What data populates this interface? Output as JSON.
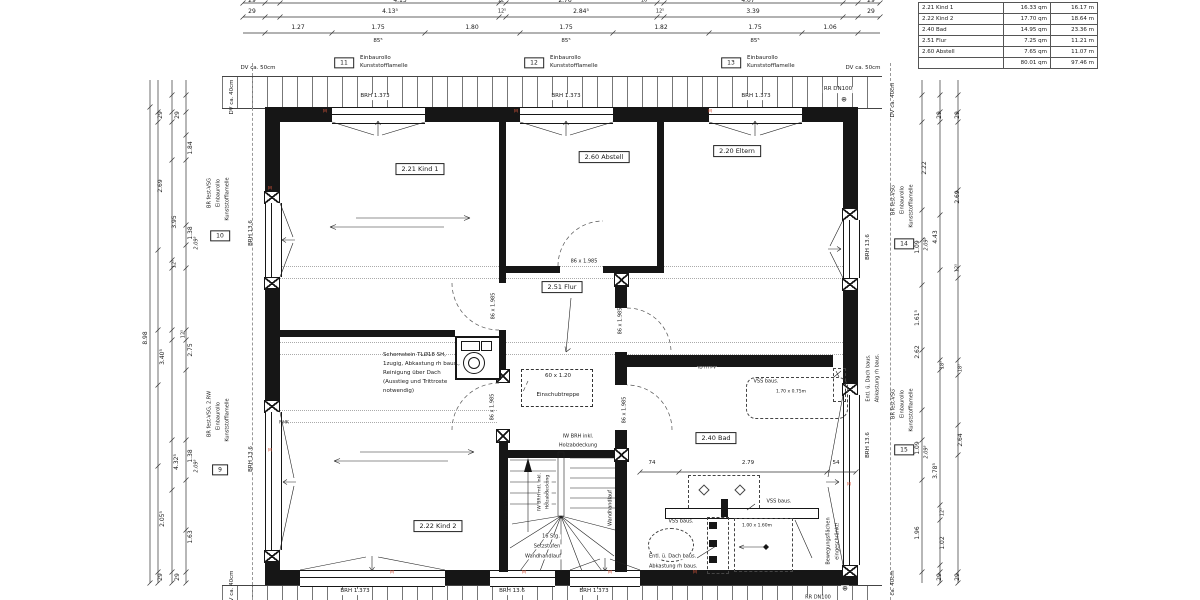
{
  "accent_red": "#d4543a",
  "area_table": {
    "rows": [
      {
        "name": "2.21 Kind 1",
        "area": "16.33 qm",
        "len": "16.17 m"
      },
      {
        "name": "2.22 Kind 2",
        "area": "17.70 qm",
        "len": "18.64 m"
      },
      {
        "name": "2.40 Bad",
        "area": "14.95 qm",
        "len": "23.36 m"
      },
      {
        "name": "2.51 Flur",
        "area": "7.25 qm",
        "len": "11.21 m"
      },
      {
        "name": "2.60 Abstell",
        "area": "7.65 qm",
        "len": "11.07 m"
      },
      {
        "name": "",
        "area": "80.01 qm",
        "len": "97.46 m"
      }
    ]
  },
  "labels": [
    {
      "n": "dim-label",
      "t": "29",
      "x": 252,
      "y": 1
    },
    {
      "n": "dim-label",
      "t": "4.15",
      "x": 400,
      "y": 1
    },
    {
      "n": "dim-label",
      "t": "12⁵",
      "x": 502,
      "y": 1,
      "s": 5
    },
    {
      "n": "dim-label",
      "t": "2.76",
      "x": 565,
      "y": 1
    },
    {
      "n": "dim-label",
      "t": "16⁵",
      "x": 645,
      "y": 1,
      "s": 5
    },
    {
      "n": "dim-label",
      "t": "4.07",
      "x": 748,
      "y": 1
    },
    {
      "n": "dim-label",
      "t": "29",
      "x": 871,
      "y": 1
    },
    {
      "n": "dim-label",
      "t": "29",
      "x": 252,
      "y": 12
    },
    {
      "n": "dim-label",
      "t": "4.13⁵",
      "x": 390,
      "y": 12
    },
    {
      "n": "dim-label",
      "t": "12⁵",
      "x": 502,
      "y": 12,
      "s": 5
    },
    {
      "n": "dim-label",
      "t": "2.84⁵",
      "x": 581,
      "y": 12
    },
    {
      "n": "dim-label",
      "t": "12⁵",
      "x": 660,
      "y": 12,
      "s": 5
    },
    {
      "n": "dim-label",
      "t": "3.39",
      "x": 753,
      "y": 12
    },
    {
      "n": "dim-label",
      "t": "29",
      "x": 871,
      "y": 12
    },
    {
      "n": "dim-label",
      "t": "1.27",
      "x": 298,
      "y": 28
    },
    {
      "n": "dim-label",
      "t": "1.75",
      "x": 378,
      "y": 28
    },
    {
      "n": "dim-label",
      "t": "1.80",
      "x": 472,
      "y": 28
    },
    {
      "n": "dim-label",
      "t": "1.75",
      "x": 566,
      "y": 28
    },
    {
      "n": "dim-label",
      "t": "1.82",
      "x": 661,
      "y": 28
    },
    {
      "n": "dim-label",
      "t": "1.75",
      "x": 755,
      "y": 28
    },
    {
      "n": "dim-label",
      "t": "1.06",
      "x": 830,
      "y": 28
    },
    {
      "n": "dim-label",
      "t": "85⁵",
      "x": 378,
      "y": 42,
      "s": 5.5
    },
    {
      "n": "dim-label",
      "t": "85⁵",
      "x": 566,
      "y": 42,
      "s": 5.5
    },
    {
      "n": "dim-label",
      "t": "85⁵",
      "x": 755,
      "y": 42,
      "s": 5.5
    },
    {
      "n": "ref-box-11",
      "t": "11",
      "x": 344,
      "y": 63,
      "b": 1
    },
    {
      "n": "ref-note",
      "t": "Einbaurollo",
      "x": 360,
      "y": 59,
      "l": 1,
      "s": 5.5
    },
    {
      "n": "ref-note",
      "t": "Kunststofflamelle",
      "x": 360,
      "y": 67,
      "l": 1,
      "s": 5.5
    },
    {
      "n": "ref-box-12",
      "t": "12",
      "x": 534,
      "y": 63,
      "b": 1
    },
    {
      "n": "ref-note",
      "t": "Einbaurollo",
      "x": 550,
      "y": 59,
      "l": 1,
      "s": 5.5
    },
    {
      "n": "ref-note",
      "t": "Kunststofflamelle",
      "x": 550,
      "y": 67,
      "l": 1,
      "s": 5.5
    },
    {
      "n": "ref-box-13",
      "t": "13",
      "x": 731,
      "y": 63,
      "b": 1
    },
    {
      "n": "ref-note",
      "t": "Einbaurollo",
      "x": 747,
      "y": 59,
      "l": 1,
      "s": 5.5
    },
    {
      "n": "ref-note",
      "t": "Kunststofflamelle",
      "x": 747,
      "y": 67,
      "l": 1,
      "s": 5.5
    },
    {
      "n": "dv-note",
      "t": "DV ca. 50cm",
      "x": 258,
      "y": 69,
      "s": 5.5
    },
    {
      "n": "dv-note",
      "t": "DV ca. 50cm",
      "x": 863,
      "y": 69,
      "s": 5.5
    },
    {
      "n": "rr-note",
      "t": "RR DN100",
      "x": 838,
      "y": 90,
      "s": 5.5,
      "bg": 1
    },
    {
      "n": "rr-symbol",
      "t": "⊕",
      "x": 844,
      "y": 100,
      "s": 7,
      "bg": 1
    },
    {
      "n": "brh-label",
      "t": "BRH 1.373",
      "x": 375,
      "y": 97,
      "s": 5.5,
      "bg": 1
    },
    {
      "n": "brh-label",
      "t": "BRH 1.373",
      "x": 566,
      "y": 97,
      "s": 5.5,
      "bg": 1
    },
    {
      "n": "brh-label",
      "t": "BRH 1.373",
      "x": 756,
      "y": 97,
      "s": 5.5,
      "bg": 1
    },
    {
      "n": "dim-label",
      "t": "8.98",
      "x": 146,
      "y": 338,
      "r": 1
    },
    {
      "n": "dim-label",
      "t": "29",
      "x": 161,
      "y": 115,
      "r": 1
    },
    {
      "n": "dim-label",
      "t": "29",
      "x": 178,
      "y": 115,
      "r": 1
    },
    {
      "n": "dim-label",
      "t": "2.69",
      "x": 161,
      "y": 186,
      "r": 1
    },
    {
      "n": "dim-label",
      "t": "3.95",
      "x": 175,
      "y": 222,
      "r": 1
    },
    {
      "n": "dim-label",
      "t": "1.84",
      "x": 191,
      "y": 148,
      "r": 1
    },
    {
      "n": "dim-label",
      "t": "1.38",
      "x": 191,
      "y": 233,
      "r": 1
    },
    {
      "n": "dim-label",
      "t": "2.09⁵",
      "x": 197,
      "y": 243,
      "r": 1,
      "it": 1,
      "s": 5
    },
    {
      "n": "dim-label",
      "t": "12⁵",
      "x": 175,
      "y": 264,
      "r": 1,
      "s": 5
    },
    {
      "n": "dim-label",
      "t": "3.40⁵",
      "x": 163,
      "y": 357,
      "r": 1
    },
    {
      "n": "dim-label",
      "t": "12⁵",
      "x": 184,
      "y": 334,
      "r": 1,
      "s": 5
    },
    {
      "n": "dim-label",
      "t": "2.75",
      "x": 191,
      "y": 350,
      "r": 1
    },
    {
      "n": "dim-label",
      "t": "4.32⁵",
      "x": 177,
      "y": 462,
      "r": 1
    },
    {
      "n": "dim-label",
      "t": "1.38",
      "x": 191,
      "y": 456,
      "r": 1
    },
    {
      "n": "dim-label",
      "t": "2.09⁵",
      "x": 197,
      "y": 466,
      "r": 1,
      "it": 1,
      "s": 5
    },
    {
      "n": "dim-label",
      "t": "2.05⁵",
      "x": 163,
      "y": 519,
      "r": 1
    },
    {
      "n": "dim-label",
      "t": "1.63",
      "x": 191,
      "y": 537,
      "r": 1
    },
    {
      "n": "dim-label",
      "t": "29",
      "x": 161,
      "y": 577,
      "r": 1
    },
    {
      "n": "dim-label",
      "t": "29",
      "x": 178,
      "y": 577,
      "r": 1
    },
    {
      "n": "ref-box-10",
      "t": "10",
      "x": 220,
      "y": 236,
      "b": 1
    },
    {
      "n": "ref-note",
      "t": "BR fest-VSG",
      "x": 210,
      "y": 193,
      "r": 1,
      "s": 5
    },
    {
      "n": "ref-note",
      "t": "Einbaurollo",
      "x": 219,
      "y": 193,
      "r": 1,
      "s": 5
    },
    {
      "n": "ref-note",
      "t": "Kunststofflamelle",
      "x": 228,
      "y": 199,
      "r": 1,
      "s": 5
    },
    {
      "n": "ref-box-9",
      "t": "9",
      "x": 220,
      "y": 470,
      "b": 1
    },
    {
      "n": "ref-note",
      "t": "BR fest-VSG, 2.RW",
      "x": 210,
      "y": 414,
      "r": 1,
      "s": 5
    },
    {
      "n": "ref-note",
      "t": "Einbaurollo",
      "x": 219,
      "y": 416,
      "r": 1,
      "s": 5
    },
    {
      "n": "ref-note",
      "t": "Kunststofflamelle",
      "x": 228,
      "y": 420,
      "r": 1,
      "s": 5
    },
    {
      "n": "brh-label",
      "t": "BRH 13.6",
      "x": 252,
      "y": 233,
      "r": 1,
      "s": 5.5
    },
    {
      "n": "brh-label",
      "t": "BRH 13.6",
      "x": 252,
      "y": 459,
      "r": 1,
      "s": 5.5
    },
    {
      "n": "dv-note",
      "t": "DV ca. 40cm",
      "x": 233,
      "y": 97,
      "r": 1,
      "s": 5.5
    },
    {
      "n": "dv-note",
      "t": "DV ca. 40cm",
      "x": 233,
      "y": 588,
      "r": 1,
      "s": 5.5
    },
    {
      "n": "dim-label",
      "t": "29",
      "x": 940,
      "y": 115,
      "r": 1
    },
    {
      "n": "dim-label",
      "t": "29",
      "x": 958,
      "y": 115,
      "r": 1
    },
    {
      "n": "dim-label",
      "t": "2.22",
      "x": 925,
      "y": 168,
      "r": 1
    },
    {
      "n": "dim-label",
      "t": "2.69",
      "x": 958,
      "y": 197,
      "r": 1
    },
    {
      "n": "dim-label",
      "t": "1.09",
      "x": 918,
      "y": 247,
      "r": 1
    },
    {
      "n": "dim-label",
      "t": "2.09⁵",
      "x": 927,
      "y": 244,
      "r": 1,
      "it": 1,
      "s": 5
    },
    {
      "n": "dim-label",
      "t": "4.43",
      "x": 936,
      "y": 237,
      "r": 1
    },
    {
      "n": "dim-label",
      "t": "12⁵",
      "x": 958,
      "y": 268,
      "r": 1,
      "s": 5
    },
    {
      "n": "dim-label",
      "t": "1.61⁵",
      "x": 918,
      "y": 318,
      "r": 1
    },
    {
      "n": "dim-label",
      "t": "2.62",
      "x": 918,
      "y": 352,
      "r": 1
    },
    {
      "n": "dim-label",
      "t": "18⁵",
      "x": 943,
      "y": 365,
      "r": 1,
      "s": 5
    },
    {
      "n": "dim-label",
      "t": "18⁵",
      "x": 961,
      "y": 368,
      "r": 1,
      "s": 5
    },
    {
      "n": "dim-label",
      "t": "1.09",
      "x": 918,
      "y": 448,
      "r": 1
    },
    {
      "n": "dim-label",
      "t": "2.09⁵",
      "x": 927,
      "y": 452,
      "r": 1,
      "it": 1,
      "s": 5
    },
    {
      "n": "dim-label",
      "t": "3.78⁵",
      "x": 936,
      "y": 471,
      "r": 1
    },
    {
      "n": "dim-label",
      "t": "2.64",
      "x": 961,
      "y": 440,
      "r": 1
    },
    {
      "n": "dim-label",
      "t": "12⁵",
      "x": 943,
      "y": 512,
      "r": 1,
      "s": 5
    },
    {
      "n": "dim-label",
      "t": "1.96",
      "x": 918,
      "y": 533,
      "r": 1
    },
    {
      "n": "dim-label",
      "t": "1.02",
      "x": 943,
      "y": 543,
      "r": 1
    },
    {
      "n": "dim-label",
      "t": "29",
      "x": 940,
      "y": 577,
      "r": 1
    },
    {
      "n": "dim-label",
      "t": "29",
      "x": 958,
      "y": 577,
      "r": 1
    },
    {
      "n": "ref-box-14",
      "t": "14",
      "x": 904,
      "y": 244,
      "b": 1
    },
    {
      "n": "ref-note",
      "t": "BR fest-VSG",
      "x": 894,
      "y": 200,
      "r": 1,
      "s": 5
    },
    {
      "n": "ref-note",
      "t": "Einbaurollo",
      "x": 903,
      "y": 200,
      "r": 1,
      "s": 5
    },
    {
      "n": "ref-note",
      "t": "Kunststofflamelle",
      "x": 912,
      "y": 206,
      "r": 1,
      "s": 5
    },
    {
      "n": "ref-box-15",
      "t": "15",
      "x": 904,
      "y": 450,
      "b": 1
    },
    {
      "n": "ref-note",
      "t": "BR fest-VSG",
      "x": 894,
      "y": 404,
      "r": 1,
      "s": 5
    },
    {
      "n": "ref-note",
      "t": "Einbaurollo",
      "x": 903,
      "y": 404,
      "r": 1,
      "s": 5
    },
    {
      "n": "ref-note",
      "t": "Kunststofflamelle",
      "x": 912,
      "y": 410,
      "r": 1,
      "s": 5
    },
    {
      "n": "brh-label",
      "t": "BRH 13.6",
      "x": 869,
      "y": 247,
      "r": 1,
      "s": 5.5
    },
    {
      "n": "brh-label",
      "t": "BRH 13.6",
      "x": 869,
      "y": 445,
      "r": 1,
      "s": 5.5
    },
    {
      "n": "vent-note",
      "t": "Entl. ü. Dach baus.",
      "x": 869,
      "y": 378,
      "r": 1,
      "s": 5
    },
    {
      "n": "vent-note",
      "t": "Abkastung rh baus.",
      "x": 878,
      "y": 378,
      "r": 1,
      "s": 5
    },
    {
      "n": "dv-note",
      "t": "DV ca. 40cm",
      "x": 894,
      "y": 100,
      "r": 1,
      "s": 5.5
    },
    {
      "n": "dv-note",
      "t": "ca. 40cm",
      "x": 894,
      "y": 583,
      "r": 1,
      "s": 5.5
    },
    {
      "n": "room-label",
      "t": "2.21 Kind 1",
      "x": 420,
      "y": 169,
      "b": 1,
      "s": 6.5
    },
    {
      "n": "room-label",
      "t": "2.60 Abstell",
      "x": 604,
      "y": 157,
      "b": 1,
      "s": 6.5
    },
    {
      "n": "room-label",
      "t": "2.20 Eltern",
      "x": 737,
      "y": 151,
      "b": 1,
      "s": 6.5
    },
    {
      "n": "room-label",
      "t": "2.51 Flur",
      "x": 562,
      "y": 287,
      "b": 1,
      "s": 6.5
    },
    {
      "n": "room-label",
      "t": "2.40 Bad",
      "x": 716,
      "y": 438,
      "b": 1,
      "s": 6.5
    },
    {
      "n": "room-label",
      "t": "2.22 Kind 2",
      "x": 438,
      "y": 526,
      "b": 1,
      "s": 6.5
    },
    {
      "n": "chimney-note",
      "t": "Schornstein TLØ18 SH,",
      "x": 383,
      "y": 356,
      "l": 1,
      "s": 5.5
    },
    {
      "n": "chimney-note",
      "t": "1zugig, Abkastung rh baus.,",
      "x": 383,
      "y": 365,
      "l": 1,
      "s": 5.5
    },
    {
      "n": "chimney-note",
      "t": "Reinigung über Dach",
      "x": 383,
      "y": 374,
      "l": 1,
      "s": 5.5
    },
    {
      "n": "chimney-note",
      "t": "(Ausstieg und Trittroste",
      "x": 383,
      "y": 383,
      "l": 1,
      "s": 5.5
    },
    {
      "n": "chimney-note",
      "t": "notwendig)",
      "x": 383,
      "y": 392,
      "l": 1,
      "s": 5.5
    },
    {
      "n": "door-size",
      "t": "86 x 1.985",
      "x": 584,
      "y": 262,
      "s": 5,
      "bg": 1
    },
    {
      "n": "door-size",
      "t": "86 x 1.985",
      "x": 494,
      "y": 306,
      "r": 1,
      "s": 5
    },
    {
      "n": "door-size",
      "t": "86 x 1.985",
      "x": 621,
      "y": 321,
      "r": 1,
      "s": 5
    },
    {
      "n": "door-size",
      "t": "86 x 1.985",
      "x": 493,
      "y": 407,
      "r": 1,
      "s": 5
    },
    {
      "n": "door-size",
      "t": "86 x 1.985",
      "x": 625,
      "y": 410,
      "r": 1,
      "s": 5
    },
    {
      "n": "hatch-size",
      "t": "60 x 1.20",
      "x": 558,
      "y": 377,
      "s": 5.5
    },
    {
      "n": "hatch-note",
      "t": "Einschubtreppe",
      "x": 558,
      "y": 396,
      "s": 5.5
    },
    {
      "n": "stair-note",
      "t": "IW BRH  inkl.",
      "x": 578,
      "y": 437,
      "s": 5,
      "bg": 1
    },
    {
      "n": "stair-note",
      "t": "Holzabdeckung",
      "x": 578,
      "y": 446,
      "s": 5,
      "bg": 1
    },
    {
      "n": "stair-note",
      "t": "Wandhandlauf",
      "x": 507,
      "y": 508,
      "r": 1,
      "s": 5
    },
    {
      "n": "stair-note",
      "t": "Wandhandlauf",
      "x": 611,
      "y": 508,
      "r": 1,
      "s": 5
    },
    {
      "n": "stair-note",
      "t": "IW BRH mtl. inkl.",
      "x": 541,
      "y": 492,
      "r": 1,
      "s": 4.5,
      "bg": 1
    },
    {
      "n": "stair-note",
      "t": "Holzabdeckung",
      "x": 549,
      "y": 492,
      "r": 1,
      "s": 4.5,
      "bg": 1
    },
    {
      "n": "stair-note",
      "t": "16 Stg.",
      "x": 551,
      "y": 537,
      "s": 5,
      "bg": 1
    },
    {
      "n": "stair-note",
      "t": "Setzstufen",
      "x": 547,
      "y": 547,
      "s": 5,
      "bg": 1
    },
    {
      "n": "stair-note",
      "t": "Wandhandlauf",
      "x": 543,
      "y": 557,
      "s": 5,
      "bg": 1
    },
    {
      "n": "dim-label",
      "t": "74",
      "x": 652,
      "y": 464,
      "s": 5.5
    },
    {
      "n": "dim-label",
      "t": "2.79",
      "x": 748,
      "y": 464,
      "s": 5.5
    },
    {
      "n": "dim-label",
      "t": "54",
      "x": 836,
      "y": 464,
      "s": 5.5
    },
    {
      "n": "fixture-note",
      "t": "VSS baus.",
      "x": 766,
      "y": 382,
      "s": 5
    },
    {
      "n": "fixture-size",
      "t": "1.70 x 0.75m",
      "x": 791,
      "y": 393,
      "s": 4.5
    },
    {
      "n": "fixture-note",
      "t": "VSS baus.",
      "x": 779,
      "y": 502,
      "s": 5,
      "bg": 1
    },
    {
      "n": "fixture-note",
      "t": "VSS baus.",
      "x": 681,
      "y": 522,
      "s": 5,
      "bg": 1
    },
    {
      "n": "fixture-size",
      "t": "1.00 x 1.60m",
      "x": 757,
      "y": 527,
      "s": 4.5
    },
    {
      "n": "vent-note",
      "t": "Entl. ü. Dach baus.",
      "x": 648,
      "y": 557,
      "l": 1,
      "s": 5,
      "bg": 1
    },
    {
      "n": "vent-note",
      "t": "Abkastung rh baus.",
      "x": 648,
      "y": 567,
      "l": 1,
      "s": 5,
      "bg": 1
    },
    {
      "n": "movement-note",
      "t": "Bewegungsflächen",
      "x": 829,
      "y": 541,
      "r": 1,
      "s": 5
    },
    {
      "n": "movement-note",
      "t": "eingeschränkt!",
      "x": 838,
      "y": 541,
      "r": 1,
      "s": 5
    },
    {
      "n": "wall-note",
      "t": "ID rh PV",
      "x": 707,
      "y": 369,
      "s": 4.5,
      "bg": 1
    },
    {
      "n": "wall-note",
      "t": "NHK",
      "x": 284,
      "y": 424,
      "s": 4.5
    },
    {
      "n": "brh-label",
      "t": "BRH 1.373",
      "x": 355,
      "y": 592,
      "s": 5.5,
      "bg": 1
    },
    {
      "n": "brh-label",
      "t": "BRH 13.6",
      "x": 512,
      "y": 592,
      "s": 5.5,
      "bg": 1
    },
    {
      "n": "brh-label",
      "t": "BRH 1.373",
      "x": 594,
      "y": 592,
      "s": 5.5,
      "bg": 1
    },
    {
      "n": "rr-note",
      "t": "RR DN100",
      "x": 818,
      "y": 598,
      "s": 5,
      "bg": 1
    },
    {
      "n": "rr-symbol",
      "t": "⊕",
      "x": 845,
      "y": 589,
      "s": 7,
      "bg": 1
    },
    {
      "n": "m-marker",
      "t": "M",
      "x": 325,
      "y": 113,
      "s": 4.5,
      "c": "#d4543a"
    },
    {
      "n": "m-marker",
      "t": "M",
      "x": 516,
      "y": 113,
      "s": 4.5,
      "c": "#d4543a"
    },
    {
      "n": "m-marker",
      "t": "M",
      "x": 710,
      "y": 113,
      "s": 4.5,
      "c": "#d4543a"
    },
    {
      "n": "m-marker",
      "t": "M",
      "x": 270,
      "y": 190,
      "s": 4.5,
      "c": "#d4543a"
    },
    {
      "n": "m-marker",
      "t": "M",
      "x": 270,
      "y": 452,
      "s": 4.5,
      "c": "#d4543a"
    },
    {
      "n": "m-marker",
      "t": "M",
      "x": 392,
      "y": 574,
      "s": 4.5,
      "c": "#d4543a"
    },
    {
      "n": "m-marker",
      "t": "M",
      "x": 524,
      "y": 574,
      "s": 4.5,
      "c": "#d4543a"
    },
    {
      "n": "m-marker",
      "t": "M",
      "x": 610,
      "y": 574,
      "s": 4.5,
      "c": "#d4543a"
    },
    {
      "n": "m-marker",
      "t": "M",
      "x": 695,
      "y": 574,
      "s": 4.5,
      "c": "#d4543a"
    },
    {
      "n": "m-marker",
      "t": "M",
      "x": 849,
      "y": 486,
      "s": 4.5,
      "c": "#d4543a"
    }
  ]
}
